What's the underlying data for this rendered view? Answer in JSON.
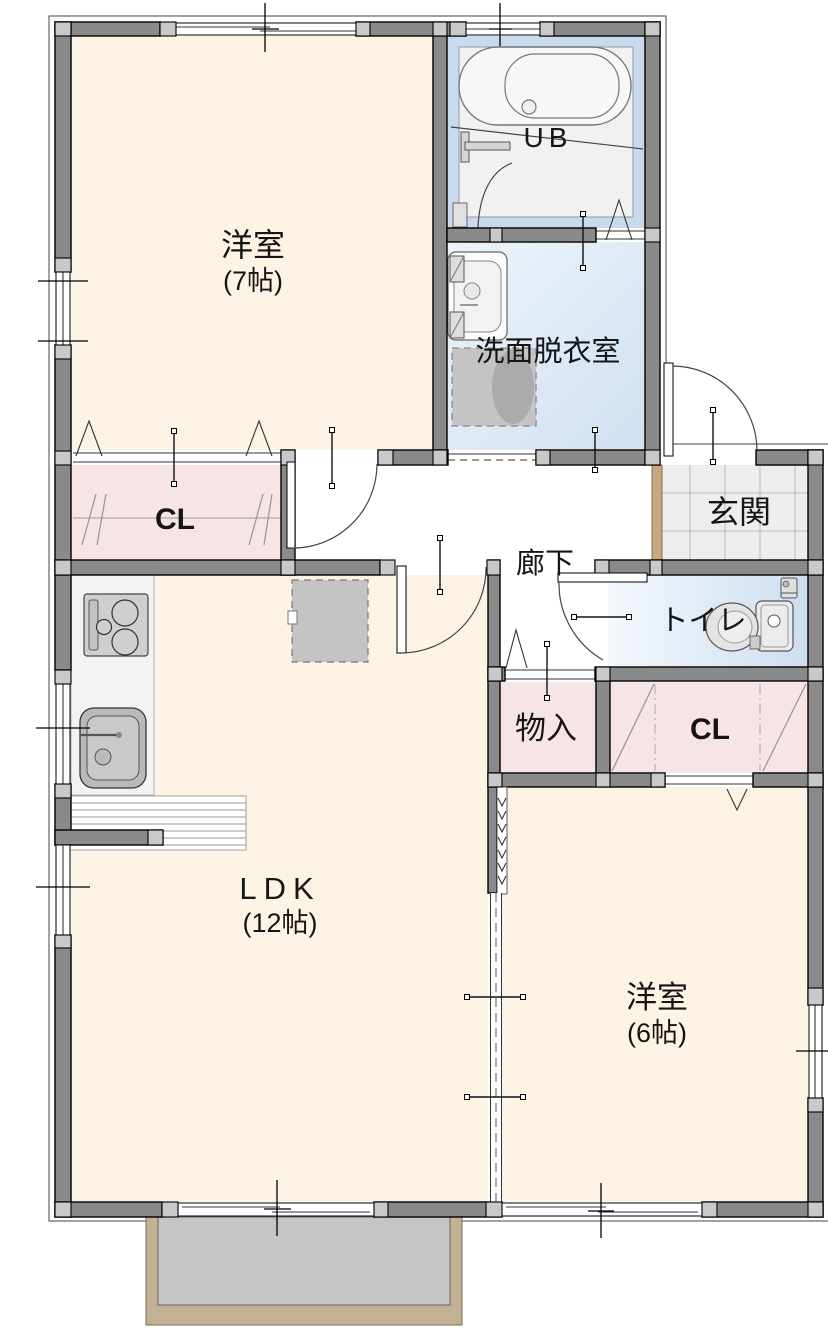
{
  "rooms": {
    "western_room_7": {
      "name": "洋室",
      "size": "(7帖)"
    },
    "unit_bath": {
      "name": "UB"
    },
    "washroom": {
      "name": "洗面脱衣室"
    },
    "entrance": {
      "name": "玄関"
    },
    "closet_left": {
      "name": "CL"
    },
    "hallway": {
      "name": "廊下"
    },
    "toilet": {
      "name": "トイレ"
    },
    "storage": {
      "name": "物入"
    },
    "closet_right": {
      "name": "CL"
    },
    "ldk": {
      "name": "LDK",
      "size": "(12帖)"
    },
    "western_room_6": {
      "name": "洋室",
      "size": "(6帖)"
    }
  },
  "colors": {
    "room_cream": "#fdf3e4",
    "closet_pink": "#f7e4e4",
    "ub_blue": "#c9d9ee",
    "wet_blue_light": "#eef4fa",
    "wet_blue_deep": "#cfe0f1",
    "wall_gray": "#8a8a8a",
    "wall_post_gray": "#c9c9c9",
    "entrance_tile": "#ededed",
    "entrance_step_tan": "#c9a87f",
    "balcony_frame_tan": "#c3b193",
    "balcony_floor_gray": "#c5c5c5",
    "fixture_gray": "#c4c4c4",
    "line_black": "#111111"
  }
}
